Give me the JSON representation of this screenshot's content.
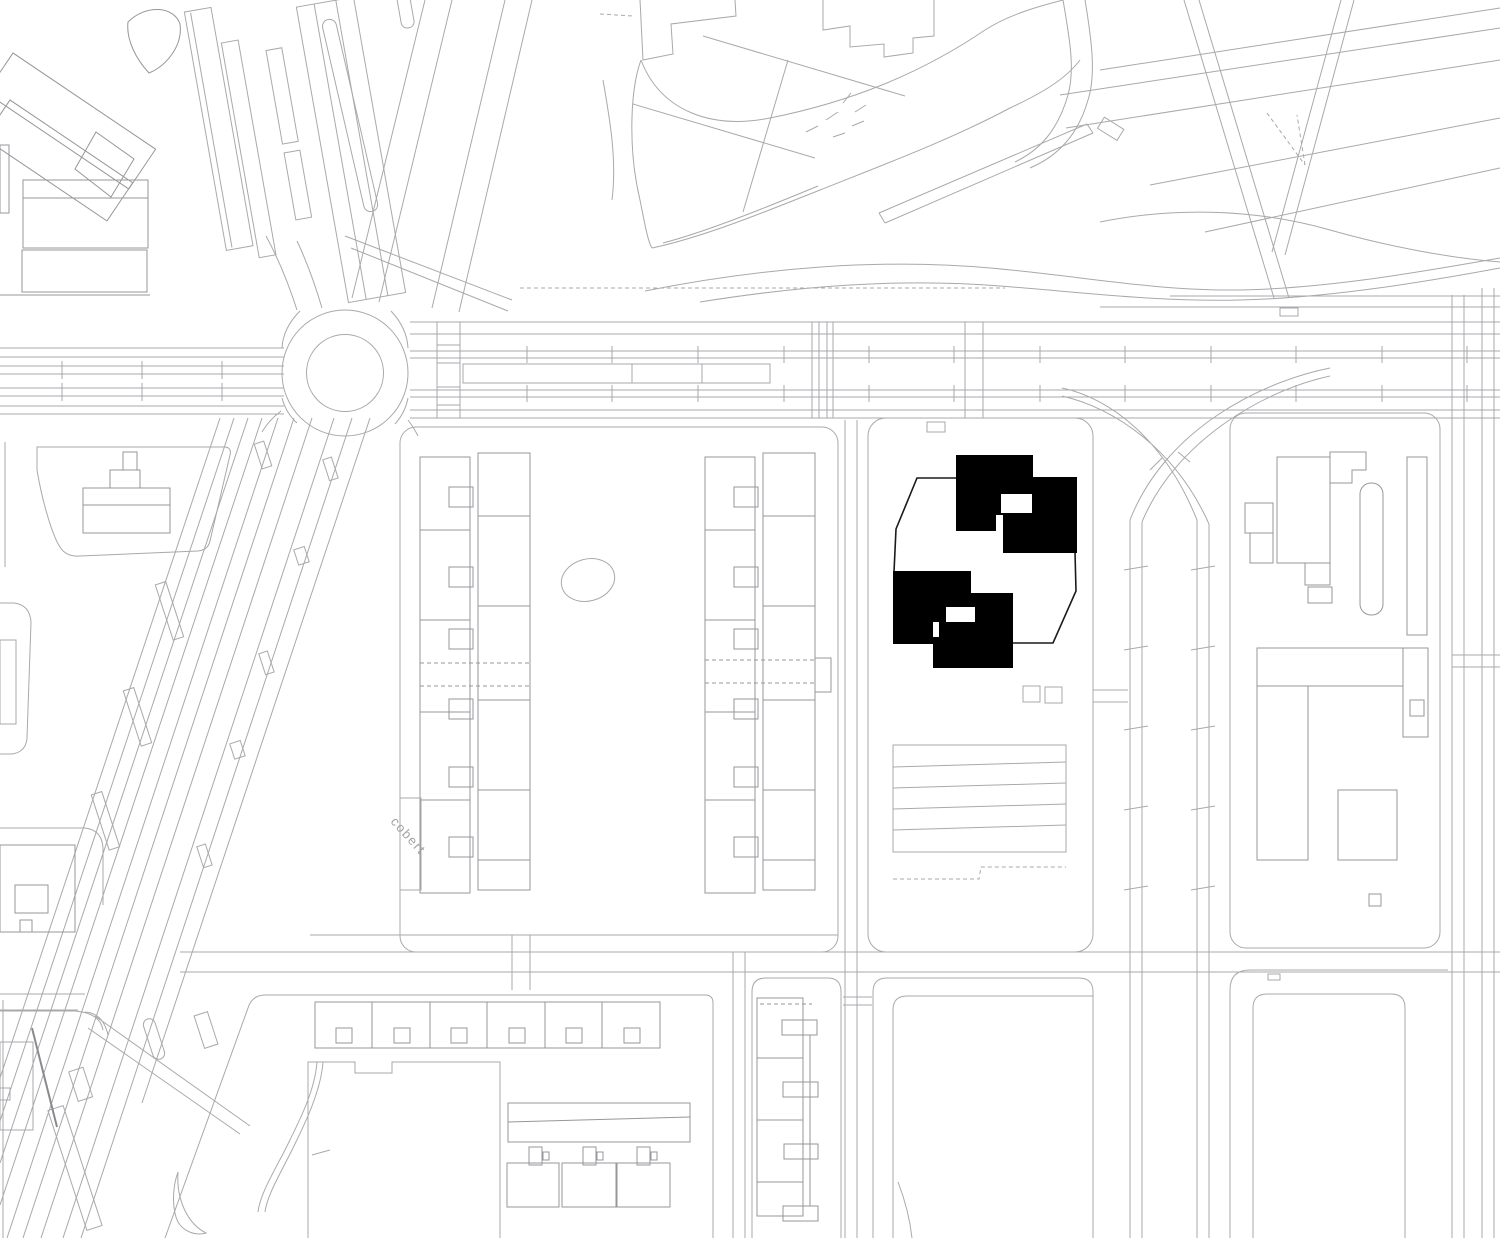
{
  "map": {
    "street_label": "cobert",
    "project": {
      "black_volume_count": 4,
      "tower_pairs": 2
    },
    "colors": {
      "background": "#ffffff",
      "linework": "#a9a9ad",
      "building_outline": "#97979b",
      "project_fill": "#000000",
      "site_boundary_stroke": "#1a1a1a",
      "label_text": "#a2a2a6"
    }
  }
}
